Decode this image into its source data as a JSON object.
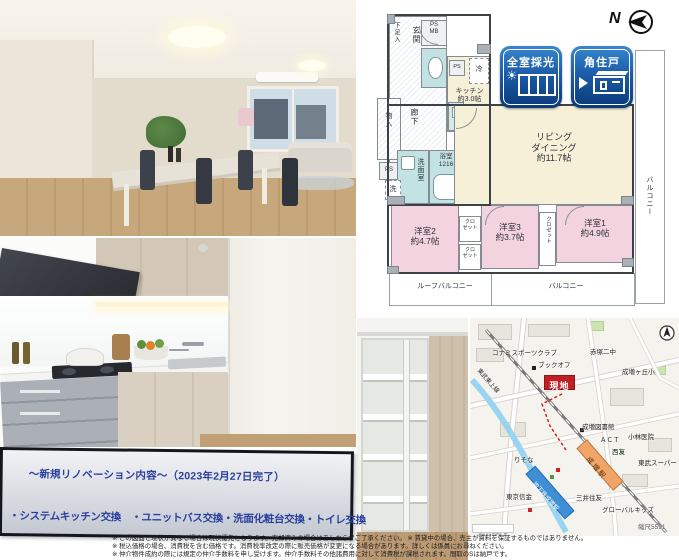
{
  "page": {
    "type": "real-estate-listing-flyer"
  },
  "colors": {
    "badge_blue_dark": "#0a3a78",
    "badge_blue_light": "#3787cf",
    "accent_navy_text": "#2b3f9e",
    "site_marker_red": "#c01f24",
    "floorplan_cream": "#f6f0d8",
    "floorplan_pink": "#f3d3de",
    "floorplan_teal": "#c3e2e3",
    "station_orange": "#f2a568",
    "metro_blue": "#3f8fd6"
  },
  "floorplan": {
    "north_label": "N",
    "badges": [
      {
        "label": "全室採光"
      },
      {
        "label": "角住戸"
      }
    ],
    "rooms": {
      "genkan": "玄関",
      "geta_box": "下足入",
      "ps_mb": "PS\nMB",
      "rouka": "廊下",
      "monoiri": "物入",
      "ps_left": "PS",
      "ps_kitchen": "PS",
      "refrigerator": "冷",
      "kitchen": "キッチン\n約3.0帖",
      "senmenshitsu": "洗面室",
      "bathroom": "浴室\n1216",
      "washer": "洗",
      "living_dining": "リビング\nダイニング\n約11.7帖",
      "bedroom2": "洋室2\n約4.7帖",
      "bedroom3": "洋室3\n約3.7帖",
      "bedroom1": "洋室1\n約4.9帖",
      "closet_small": "クロ\nゼット",
      "closet_vertical": "クロゼット",
      "roof_balcony": "ルーフバルコニー",
      "balcony_bottom": "バルコニー",
      "balcony_right": "バルコニー"
    }
  },
  "map": {
    "labels": {
      "konami": "コナミスポーツクラブ",
      "bookoff": "ブックオフ",
      "site": "現地",
      "akatsuka_jhs": "赤塚二中",
      "narimasugaoka_es": "成増ヶ丘小",
      "tobu_tojo_line": "東武東上線",
      "library": "成増図書館",
      "act": "ＡＣＴ",
      "kobayashi_clinic": "小林医院",
      "seiyu": "西友",
      "tobu_super": "東武スーパー",
      "risona": "りそな",
      "narimasu_sta": "成増駅",
      "chikatetsu_narimasu_sta": "地下鉄成増駅",
      "tokyo_shinkin": "東京信金",
      "mitsui_sumitomo": "三井住友",
      "global_kids": "グローバルキッズ",
      "copyright": "©MAPPLE",
      "scale": "縮尺5591"
    }
  },
  "renovation_box": {
    "title": "〜新規リノベーション内容〜（2023年2月27日完了）",
    "items": "・システムキッチン交換　・ユニットバス交換・洗面化粧台交換・トイレ交換"
  },
  "disclaimer": {
    "line1": "※ この図面と現状が異なる場合は現状優先となります。売却済みの場合はあしからずご了承ください。 ※ 賃貸中の場合、売主が資料を保証するものではありません。",
    "line2": "※ 税込価格の場合、消費税を含む価格です。消費税率改定の際に販売価格が変更になる場合があります。詳しくは係員にお尋ねください。",
    "line3": "※ 仲介物件成約の際には規定の仲介手数料を申し受けます。仲介手数料その他諸費用に対して消費税が課税されます。間取のSは納戸です。"
  }
}
